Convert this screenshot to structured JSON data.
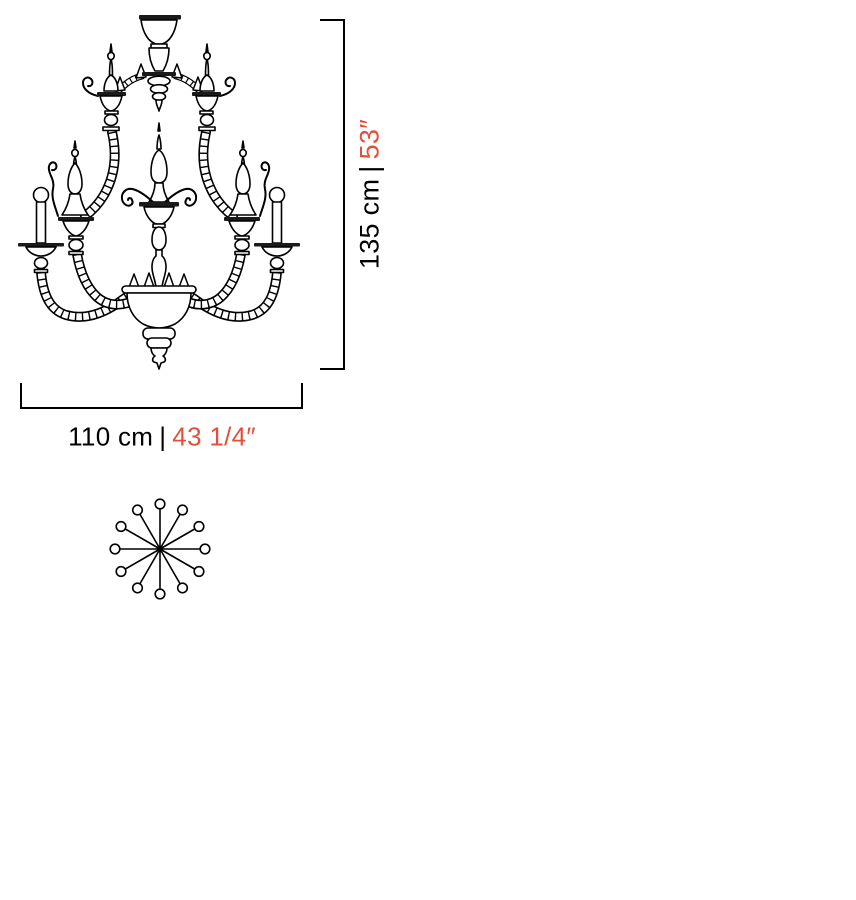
{
  "page": {
    "background_color": "#ffffff"
  },
  "colors": {
    "line": "#000000",
    "text": "#000000",
    "accent_red": "#e2503c"
  },
  "dimensions": {
    "height": {
      "metric": "135 cm",
      "separator": "|",
      "imperial": "53″"
    },
    "width": {
      "metric": "110 cm",
      "separator": "|",
      "imperial": "43 1/4″"
    }
  },
  "top_view": {
    "lights_count": 12,
    "spoke_length": 45,
    "bulb_radius": 4.8,
    "hub_radius": 3.2
  }
}
